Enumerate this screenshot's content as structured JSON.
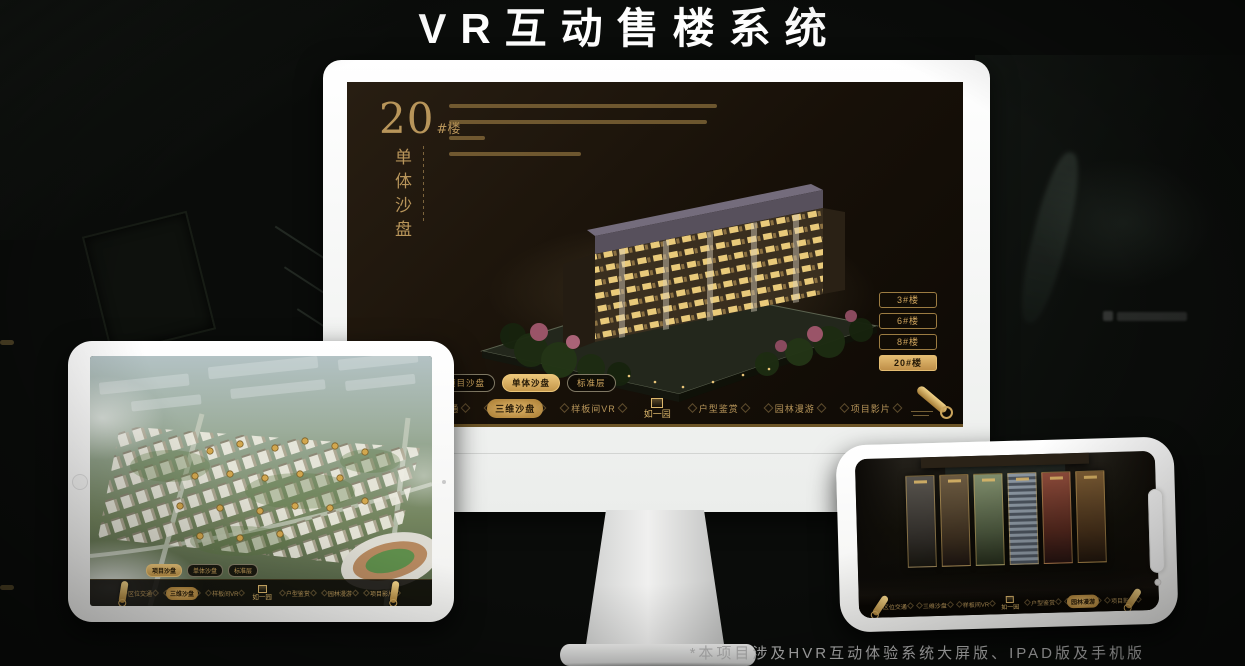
{
  "page": {
    "title": "VR互动售楼系统",
    "footnote": "*本项目涉及HVR互动体验系统大屏版、IPAD版及手机版"
  },
  "colors": {
    "gold": "#c9a263",
    "gold_bright": "#e4bd72",
    "gold_dark": "#8a6d34",
    "screen_bg": "#171008",
    "page_bg": "#0a0c0a",
    "device_bezel": "#f4f4f2",
    "active_text": "#241806"
  },
  "icons": {
    "menu_scroll": "gold-scroll-icon",
    "home": "home-button",
    "camera": "camera-dot",
    "notch": "notch-pill",
    "logo_mark": "seal-mark"
  },
  "nav_logo": "如一园",
  "monitor": {
    "building_no": "20",
    "building_no_suffix": "#楼",
    "mode_title": "单体沙盘",
    "floor_buttons": [
      "3#楼",
      "6#楼",
      "8#楼",
      "20#楼"
    ],
    "active_floor": "20#楼",
    "tabs": [
      "项目沙盘",
      "单体沙盘",
      "标准层"
    ],
    "active_tab": "单体沙盘",
    "nav_items": [
      "区位交通",
      "三维沙盘",
      "样板间VR",
      "户型鉴赏",
      "园林漫游",
      "项目影片"
    ],
    "active_nav": "三维沙盘"
  },
  "tablet": {
    "tabs": [
      "项目沙盘",
      "单体沙盘",
      "标准层"
    ],
    "active_tab": "项目沙盘",
    "nav_items": [
      "区位交通",
      "三维沙盘",
      "样板间VR",
      "户型鉴赏",
      "园林漫游",
      "项目影片"
    ],
    "active_nav": "三维沙盘"
  },
  "phone": {
    "nav_items": [
      "区位交通",
      "三维沙盘",
      "样板间VR",
      "户型鉴赏",
      "园林漫游",
      "项目影片"
    ],
    "active_nav": "园林漫游"
  }
}
